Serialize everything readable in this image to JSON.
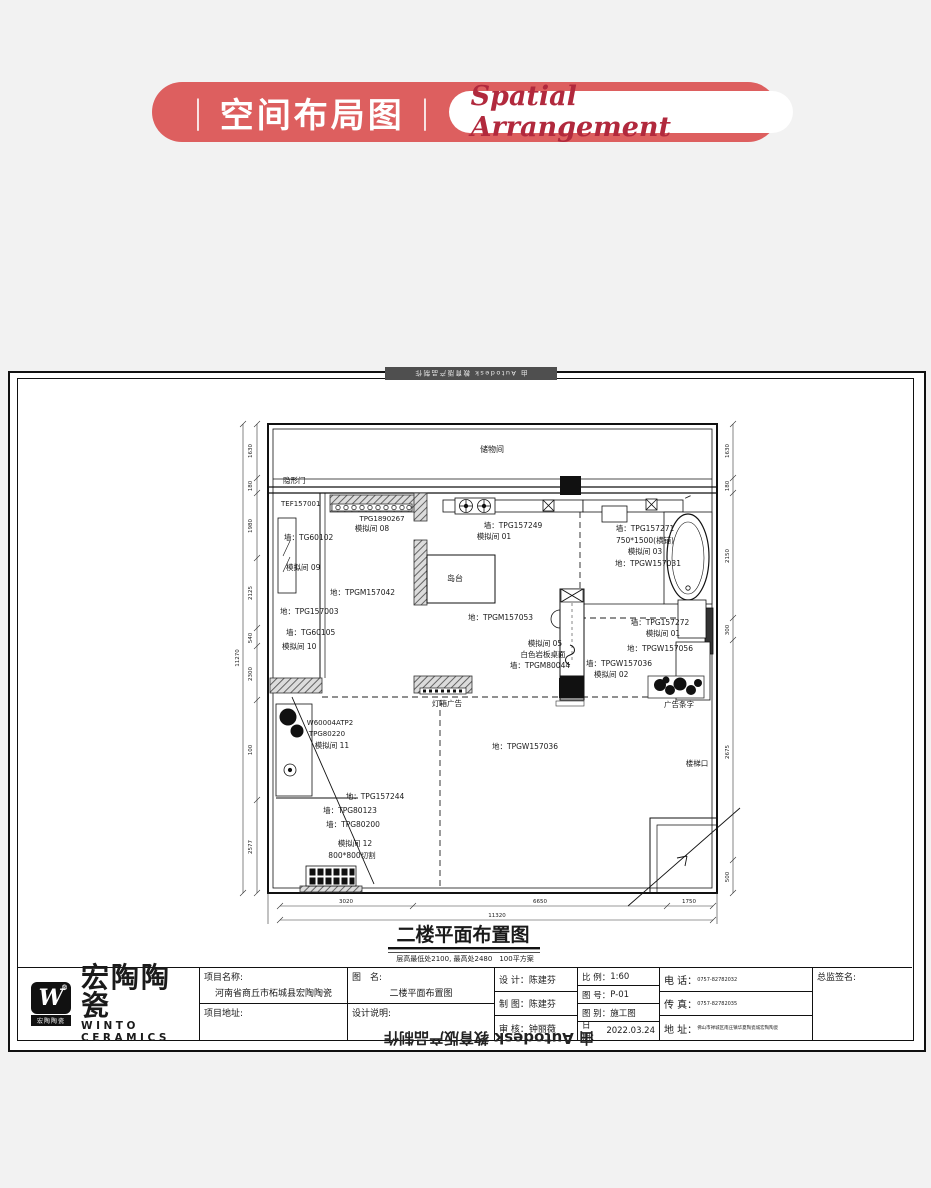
{
  "header": {
    "bar": "|",
    "title_cn": "空间布局图",
    "title_en": "Spatial Arrangement",
    "pill_color": "#dd5f5f",
    "accent_color": "#b1293d"
  },
  "watermark": {
    "top": "由 Autodesk 教育版产品制作",
    "bottom": "由 Autodesk 教育版产品制作"
  },
  "plan_labels": [
    "储物间",
    "隐形门",
    "TEF157001",
    "TPG1890267",
    "模拟间 08",
    "墙：TPG157249",
    "模拟间 01",
    "墙：TPG157271",
    "750*1500(横铺)",
    "模拟间 03",
    "地：TPGW157031",
    "墙：TG60102",
    "模拟间 09",
    "岛台",
    "地：TPGM157042",
    "地：TPG157003",
    "墙：TG60105",
    "模拟间 10",
    "地：TPGM157053",
    "模拟间 05",
    "白色岩板桌面",
    "墙：TPGM80044",
    "墙：TPGW157036",
    "模拟间 02",
    "墙：TPG157272",
    "模拟间 01",
    "地：TPGW157056",
    "灯箱广告",
    "广告条字",
    "W60004ATP2",
    "TPG80220",
    "模拟间 11",
    "地：TPG157244",
    "墙：TPG80123",
    "墙：TPG80200",
    "模拟间 12",
    "800*800切割",
    "地：TPGW157036",
    "楼梯口"
  ],
  "dims": {
    "left": [
      "1630",
      "180",
      "1980",
      "2125",
      "540",
      "2300",
      "100",
      "2577"
    ],
    "left_total": "11270",
    "right": [
      "1630",
      "180",
      "2150",
      "300",
      "2675",
      "500"
    ],
    "bottom": [
      "3020",
      "6650",
      "1750"
    ],
    "bottom_total": "11320"
  },
  "drawing_title": {
    "text": "二楼平面布置图",
    "note": "层高最低处2100, 最高处2480　100平方案"
  },
  "titleblock": {
    "brand_cn": "宏陶陶瓷",
    "brand_en": "WINTO CERAMICS",
    "mark_letter": "W",
    "mark_reg": "®",
    "mark_band": "宏陶陶瓷",
    "project_name_label": "项目名称:",
    "project_name": "河南省商丘市柘城县宏陶陶瓷",
    "project_addr_label": "项目地址:",
    "fig_name_label": "图　名:",
    "fig_name": "二楼平面布置图",
    "design_note_label": "设计说明:",
    "designer_label": "设 计：",
    "designer": "陈建芬",
    "drafter_label": "制 图：",
    "drafter": "陈建芬",
    "checker_label": "审 核：",
    "checker": "钟丽薇",
    "scale_label": "比 例：",
    "scale": "1:60",
    "fig_no_label": "图 号：",
    "fig_no": "P-01",
    "fig_type_label": "图 别：",
    "fig_type": "施工图",
    "date_label": "日 期：",
    "date": "2022.03.24",
    "tel_label": "电 话：",
    "tel": "0757-82782032",
    "fax_label": "传 真：",
    "fax": "0757-82782035",
    "addr_label": "地 址：",
    "addr": "佛山市禅城区南庄镇华夏陶瓷城宏陶陶瓷",
    "sign_label": "总监签名:"
  }
}
